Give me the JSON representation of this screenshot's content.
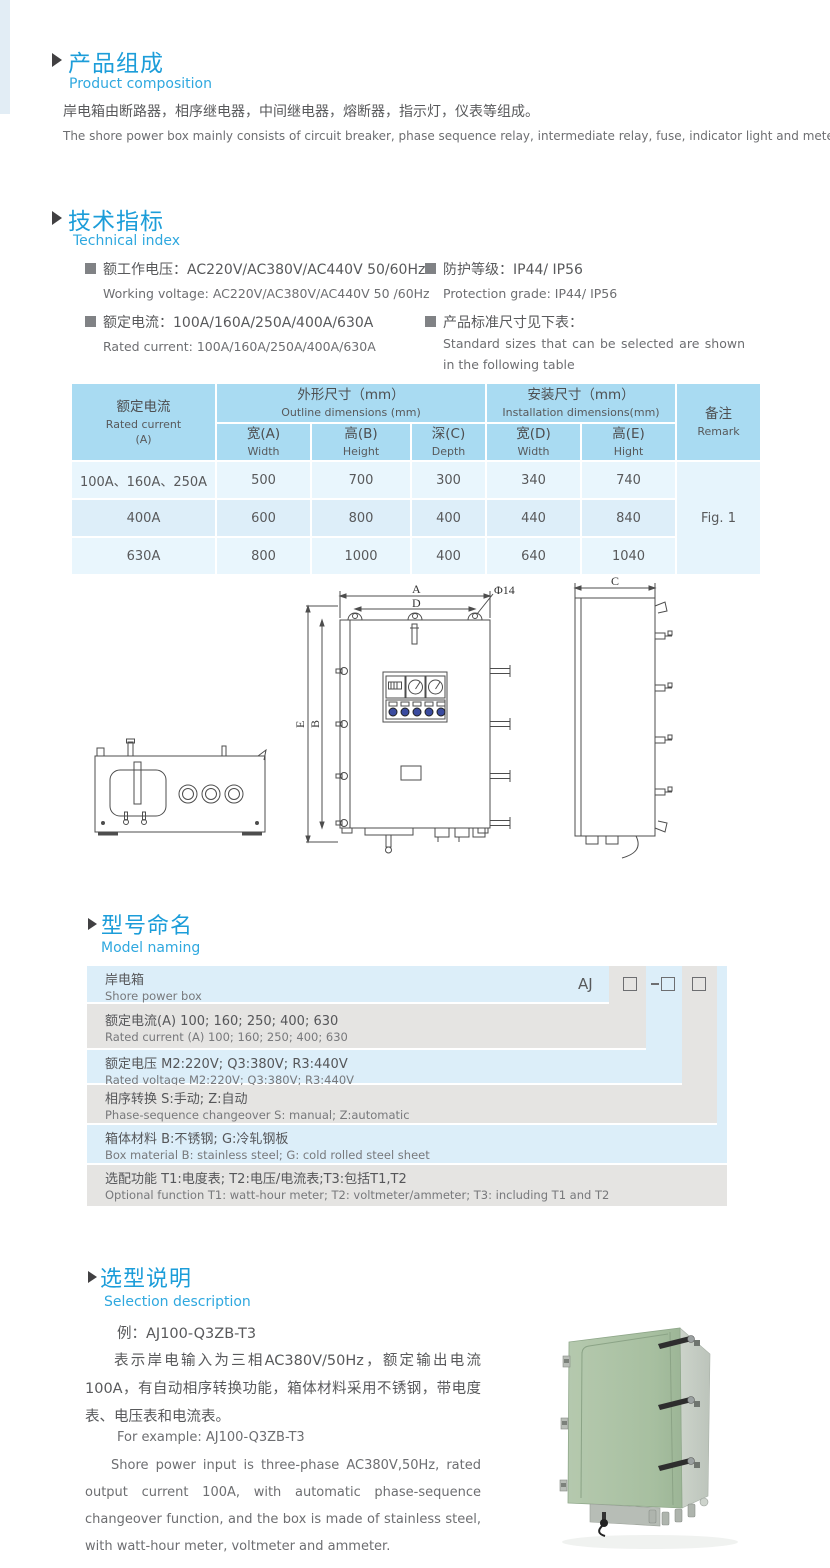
{
  "colors": {
    "accent_title": "#1c9dd9",
    "accent_sub": "#2fa8df",
    "table_header": "#a9dbf2",
    "table_row_light": "#e9f6fd",
    "table_row_mid": "#ddeef9",
    "stair_blue": "#dceef9",
    "stair_gray": "#e5e4e2",
    "photo_green": "#a9c0a3"
  },
  "composition": {
    "title_zh": "产品组成",
    "title_en": "Product  composition",
    "body_zh": "岸电箱由断路器，相序继电器，中间继电器，熔断器，指示灯，仪表等组成。",
    "body_en": "The shore power box mainly consists of circuit breaker, phase sequence relay, intermediate relay, fuse, indicator light and meter."
  },
  "technical": {
    "title_zh": "技术指标",
    "title_en": "Technical index",
    "specs": [
      {
        "zh": "额工作电压：AC220V/AC380V/AC440V  50/60Hz",
        "en": "Working voltage: AC220V/AC380V/AC440V 50 /60Hz"
      },
      {
        "zh": "额定电流：100A/160A/250A/400A/630A",
        "en": "Rated current: 100A/160A/250A/400A/630A"
      },
      {
        "zh": "防护等级：IP44/ IP56",
        "en": "Protection grade: IP44/ IP56"
      },
      {
        "zh": "产品标准尺寸见下表：",
        "en": "Standard sizes that can be selected are shown in the following table"
      }
    ]
  },
  "dim_table": {
    "rated_zh": "额定电流",
    "rated_en": "Rated current",
    "rated_unit": "(A)",
    "outline_zh": "外形尺寸（mm）",
    "outline_en": "Outline dimensions (mm)",
    "install_zh": "安装尺寸（mm）",
    "install_en": "Installation dimensions(mm)",
    "remark_zh": "备注",
    "remark_en": "Remark",
    "subcols": [
      {
        "zh": "宽(A)",
        "en": "Width"
      },
      {
        "zh": "高(B)",
        "en": "Height"
      },
      {
        "zh": "深(C)",
        "en": "Depth"
      },
      {
        "zh": "宽(D)",
        "en": "Width"
      },
      {
        "zh": "高(E)",
        "en": "Hight"
      }
    ],
    "rows": [
      {
        "rated": "100A、160A、250A",
        "a": "500",
        "b": "700",
        "c": "300",
        "d": "340",
        "e": "740"
      },
      {
        "rated": "400A",
        "a": "600",
        "b": "800",
        "c": "400",
        "d": "440",
        "e": "840"
      },
      {
        "rated": "630A",
        "a": "800",
        "b": "1000",
        "c": "400",
        "d": "640",
        "e": "1040"
      }
    ],
    "remark_value": "Fig. 1"
  },
  "drawing": {
    "labels": {
      "a": "A",
      "b": "B",
      "c": "C",
      "d": "D",
      "e": "E",
      "phi": "Φ14"
    }
  },
  "model": {
    "title_zh": "型号命名",
    "title_en": "Model naming",
    "prefix": "AJ",
    "rows": [
      {
        "zh": "岸电箱",
        "en": "Shore power box"
      },
      {
        "zh": "额定电流(A)  100; 160; 250; 400; 630",
        "en": "Rated current (A)  100; 160; 250; 400; 630"
      },
      {
        "zh": "额定电压   M2:220V;  Q3:380V;  R3:440V",
        "en": "Rated voltage   M2:220V;  Q3:380V;  R3:440V"
      },
      {
        "zh": "相序转换  S:手动; Z:自动",
        "en": "Phase-sequence changeover  S: manual;  Z:automatic"
      },
      {
        "zh": "箱体材料      B:不锈钢;  G:冷轧钢板",
        "en": "Box material    B: stainless steel; G: cold rolled steel sheet"
      },
      {
        "zh": "选配功能        T1:电度表;  T2:电压/电流表;T3:包括T1,T2",
        "en": "Optional function  T1: watt-hour meter; T2: voltmeter/ammeter; T3: including T1 and T2"
      }
    ]
  },
  "selection": {
    "title_zh": "选型说明",
    "title_en": "Selection description",
    "example_zh": "例：AJ100-Q3ZB-T3",
    "body_zh": "表示岸电输入为三相AC380V/50Hz，额定输出电流100A，有自动相序转换功能，箱体材料采用不锈钢，带电度表、电压表和电流表。",
    "example_en": "For example: AJ100-Q3ZB-T3",
    "body_en": "Shore power input is three-phase AC380V,50Hz, rated output current 100A, with automatic phase-sequence changeover function, and the box is made of stainless steel, with watt-hour meter, voltmeter and ammeter."
  }
}
